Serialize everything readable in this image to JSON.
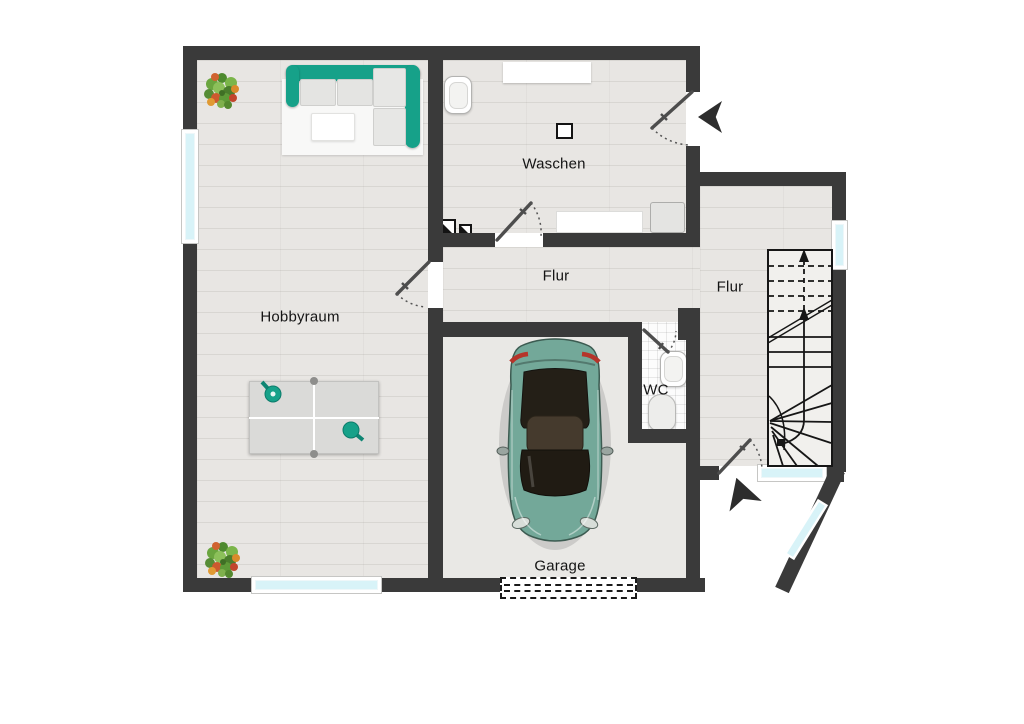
{
  "plan": {
    "rooms": [
      {
        "id": "hobbyraum",
        "label": "Hobbyraum"
      },
      {
        "id": "waschen",
        "label": "Waschen"
      },
      {
        "id": "flur",
        "label": "Flur"
      },
      {
        "id": "flur-treppe",
        "label": "Flur"
      },
      {
        "id": "wc",
        "label": "WC"
      },
      {
        "id": "garage",
        "label": "Garage"
      }
    ],
    "colors": {
      "wall": "#3a3a3a",
      "wood_floor": "#e8e6e3",
      "garage_floor": "#e9e8e5",
      "accent_teal": "#16a189",
      "window_glass": "#d8f3f8",
      "car_body": "#73a899"
    },
    "symbols": [
      "entrance-arrow",
      "staircase-up",
      "garage-door",
      "door-swing",
      "floor-step-symbol",
      "plant",
      "corner-sofa",
      "ping-pong-table",
      "car-top-view",
      "sink",
      "toilet",
      "washing-counter"
    ]
  }
}
